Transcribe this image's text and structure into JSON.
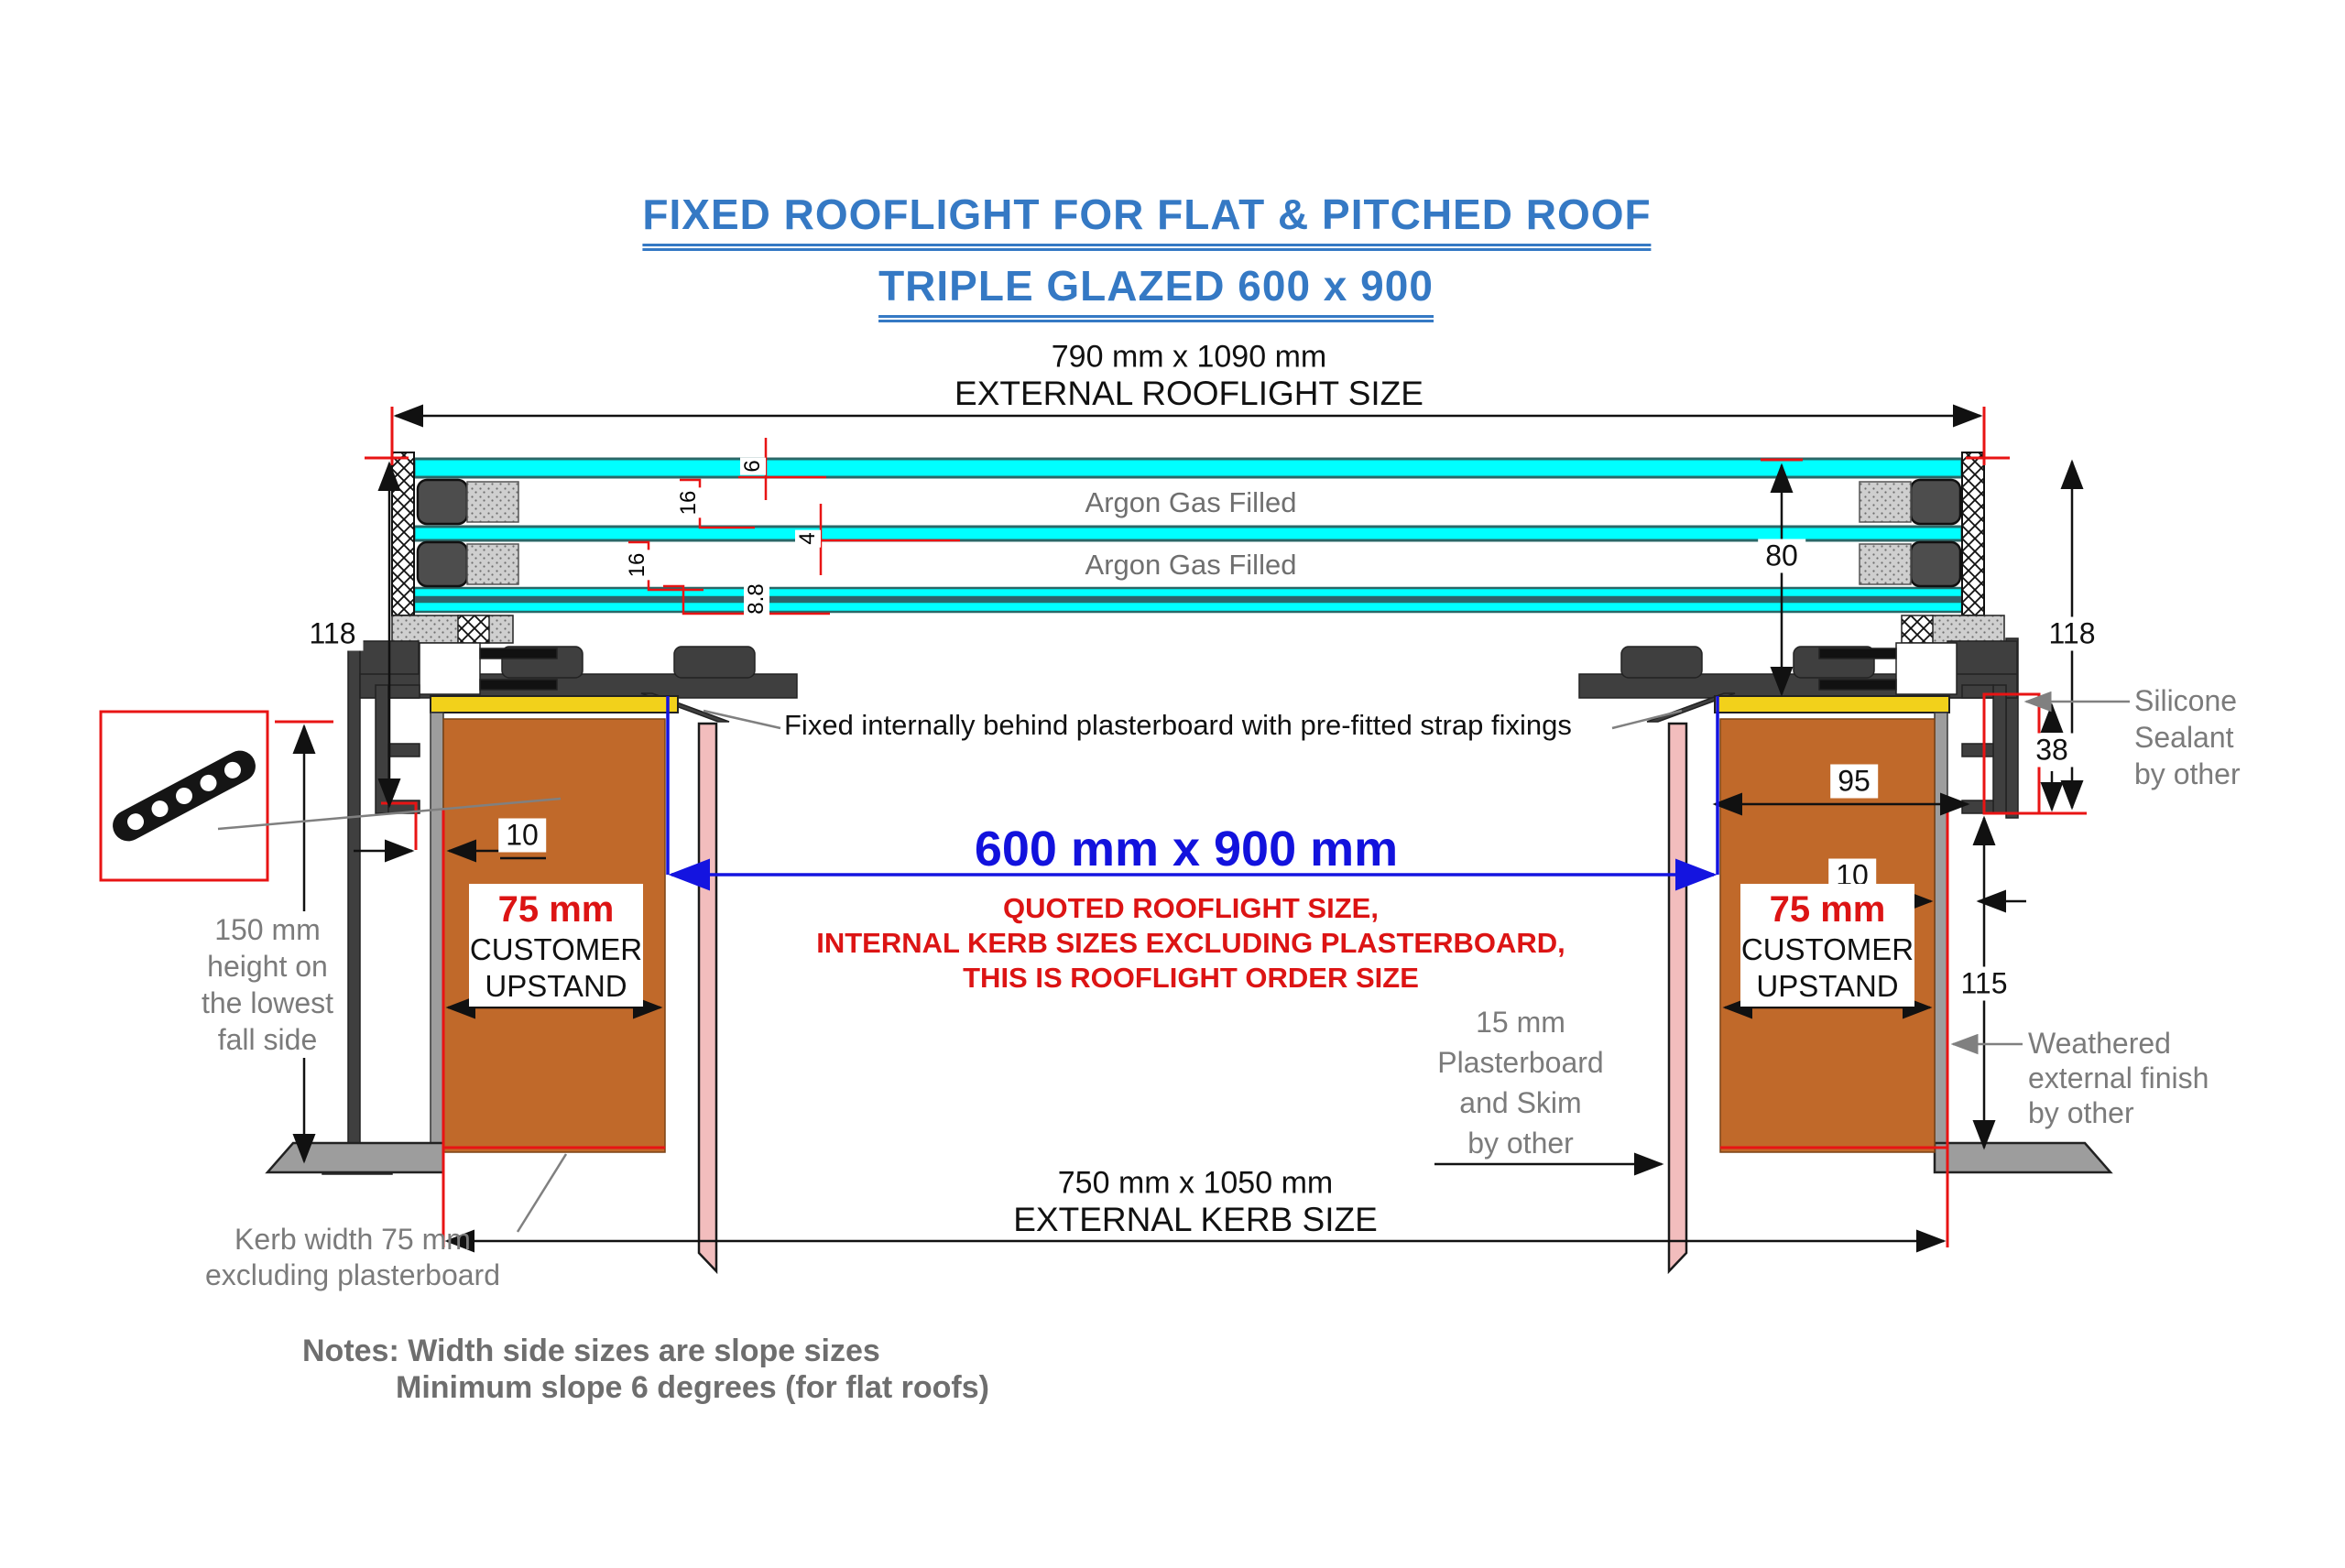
{
  "title": {
    "line1": "FIXED ROOFLIGHT FOR FLAT & PITCHED ROOF",
    "line2": "TRIPLE GLAZED 600 x 900"
  },
  "external_rooflight": {
    "size": "790 mm x 1090 mm",
    "label": "EXTERNAL ROOFLIGHT SIZE"
  },
  "external_kerb": {
    "size": "750 mm x 1050 mm",
    "label": "EXTERNAL KERB SIZE"
  },
  "quoted": {
    "size": "600 mm x 900 mm",
    "note1": "QUOTED ROOFLIGHT SIZE,",
    "note2": "INTERNAL KERB SIZES EXCLUDING PLASTERBOARD,",
    "note3": "THIS IS ROOFLIGHT ORDER SIZE"
  },
  "glazing": {
    "argon": "Argon Gas Filled",
    "dims": [
      "6",
      "16",
      "4",
      "16",
      "8.8"
    ],
    "unit_height": "80"
  },
  "dims": {
    "frame_height_left": "118",
    "frame_height_right": "118",
    "gap_left": "10",
    "gap_right": "10",
    "kerb_face": "95",
    "sealant_gap": "38",
    "finish_height": "115"
  },
  "upstand": {
    "size": "75 mm",
    "line1": "CUSTOMER",
    "line2": "UPSTAND"
  },
  "strap_note": "Fixed internally behind plasterboard with pre-fitted strap fixings",
  "left_height_note": [
    "150 mm",
    "height on",
    "the lowest",
    "fall side"
  ],
  "plasterboard_note": [
    "15 mm",
    "Plasterboard",
    "and Skim",
    "by other"
  ],
  "silicone_note": [
    "Silicone",
    "Sealant",
    "by other"
  ],
  "weathered_note": [
    "Weathered",
    "external finish",
    "by other"
  ],
  "kerb_width_note": [
    "Kerb width 75 mm",
    "excluding plasterboard"
  ],
  "notes": [
    "Notes: Width side sizes are slope sizes",
    "Minimum slope 6 degrees (for flat roofs)"
  ],
  "colors": {
    "title_blue": "#3579c4",
    "quoted_blue": "#1212dd",
    "warning_red": "#dc1414",
    "dimension_red": "#e81414",
    "glass_cyan": "#00ffff",
    "kerb_orange": "#c0692a",
    "sealant_yellow": "#f2d11b",
    "plasterboard_pink": "#f2bdbd",
    "frame_gray": "#3f3f3f",
    "finish_gray": "#9d9d9d",
    "annotation_gray": "#7b7b7b"
  }
}
